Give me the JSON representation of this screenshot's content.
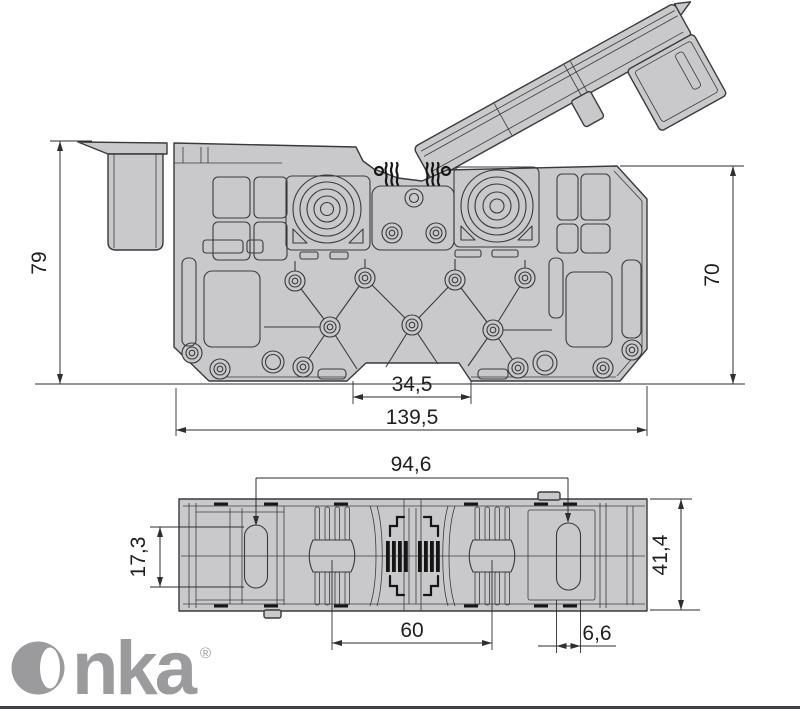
{
  "colors": {
    "background": "#ffffff",
    "body_fill": "#c9c9cb",
    "line": "#3a3a3c",
    "dim_line": "#2e2e30",
    "dim_text": "#1f1f21",
    "spring_dark": "#151515",
    "logo_gray": "#9b9b9d",
    "footer_bar": "#404042"
  },
  "dimensions": {
    "d79": {
      "label": "79"
    },
    "d70": {
      "label": "70"
    },
    "d34_5": {
      "label": "34,5"
    },
    "d139_5": {
      "label": "139,5"
    },
    "d94_6": {
      "label": "94,6"
    },
    "d17_3": {
      "label": "17,3"
    },
    "d41_4": {
      "label": "41,4"
    },
    "d60": {
      "label": "60"
    },
    "d6_6": {
      "label": "6,6"
    }
  },
  "logo": {
    "text": "Onka",
    "registered_mark": "®"
  }
}
